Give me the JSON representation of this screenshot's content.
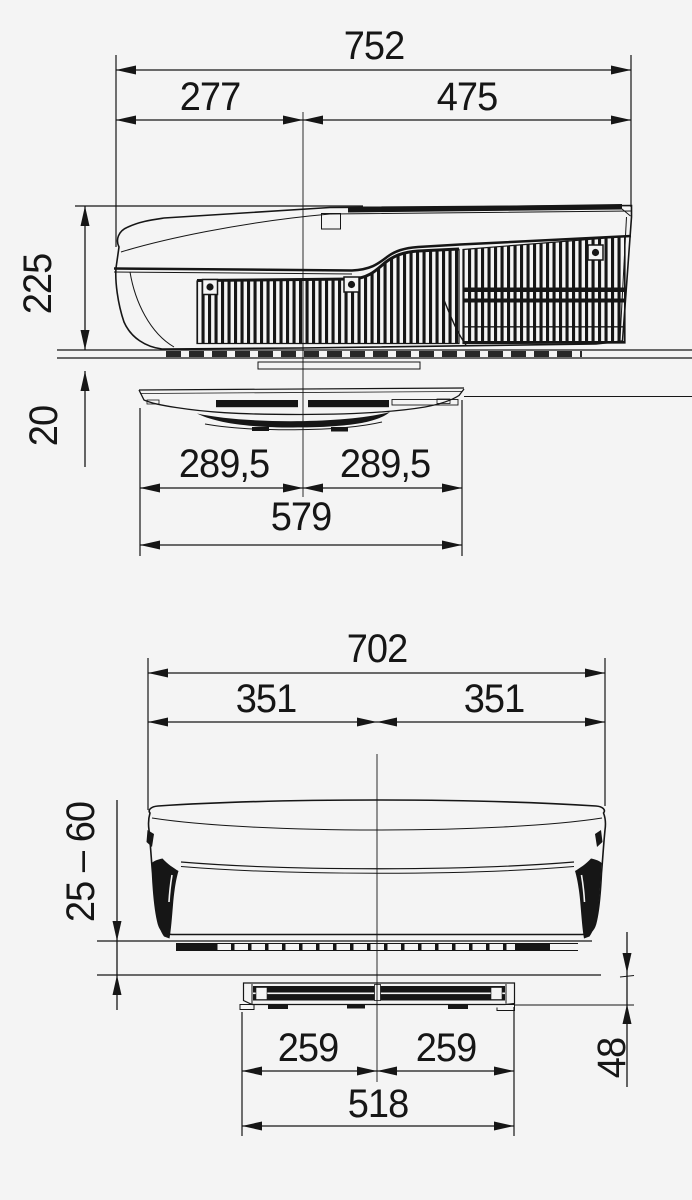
{
  "style": {
    "background": "#f4f4f4",
    "ink": "#161616"
  },
  "side_view": {
    "dimensions": {
      "overall_length": "752",
      "front_section": "277",
      "grille_section": "475",
      "unit_height": "225",
      "roof_to_distributor": "20",
      "distributor_left_half": "289,5",
      "distributor_right_half": "289,5",
      "distributor_length": "579"
    }
  },
  "front_view": {
    "dimensions": {
      "overall_width": "702",
      "left_half": "351",
      "right_half": "351",
      "roof_thickness_range": "25 – 60",
      "distributor_height": "48",
      "cutout_left_half": "259",
      "cutout_right_half": "259",
      "cutout_width": "518"
    }
  }
}
